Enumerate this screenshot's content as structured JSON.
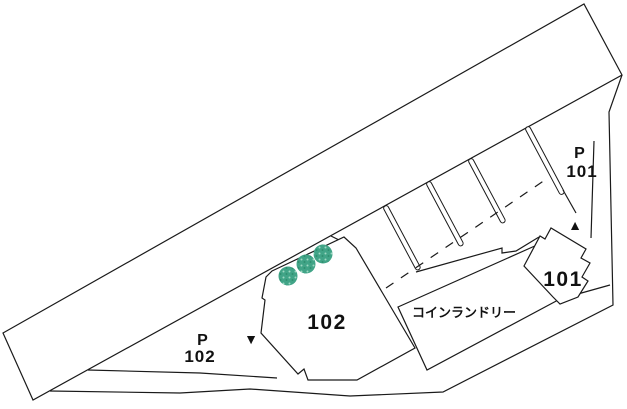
{
  "plan": {
    "parking_101": {
      "p": "P",
      "num": "101"
    },
    "parking_102": {
      "p": "P",
      "num": "102"
    },
    "building_101_label": "101",
    "building_102_label": "102",
    "laundry_label": "コインランドリー",
    "marker_down": "▼",
    "marker_up": "▲"
  },
  "icons": {
    "trees": {
      "name": "tree-icon",
      "count": 3
    }
  },
  "colors": {
    "background": "#ffffff",
    "line": "#1a1a1a",
    "tree_fill": "#41a487",
    "tree_dot_light": "#9ed8c2",
    "tree_dot_dark": "#2e8f6f"
  }
}
